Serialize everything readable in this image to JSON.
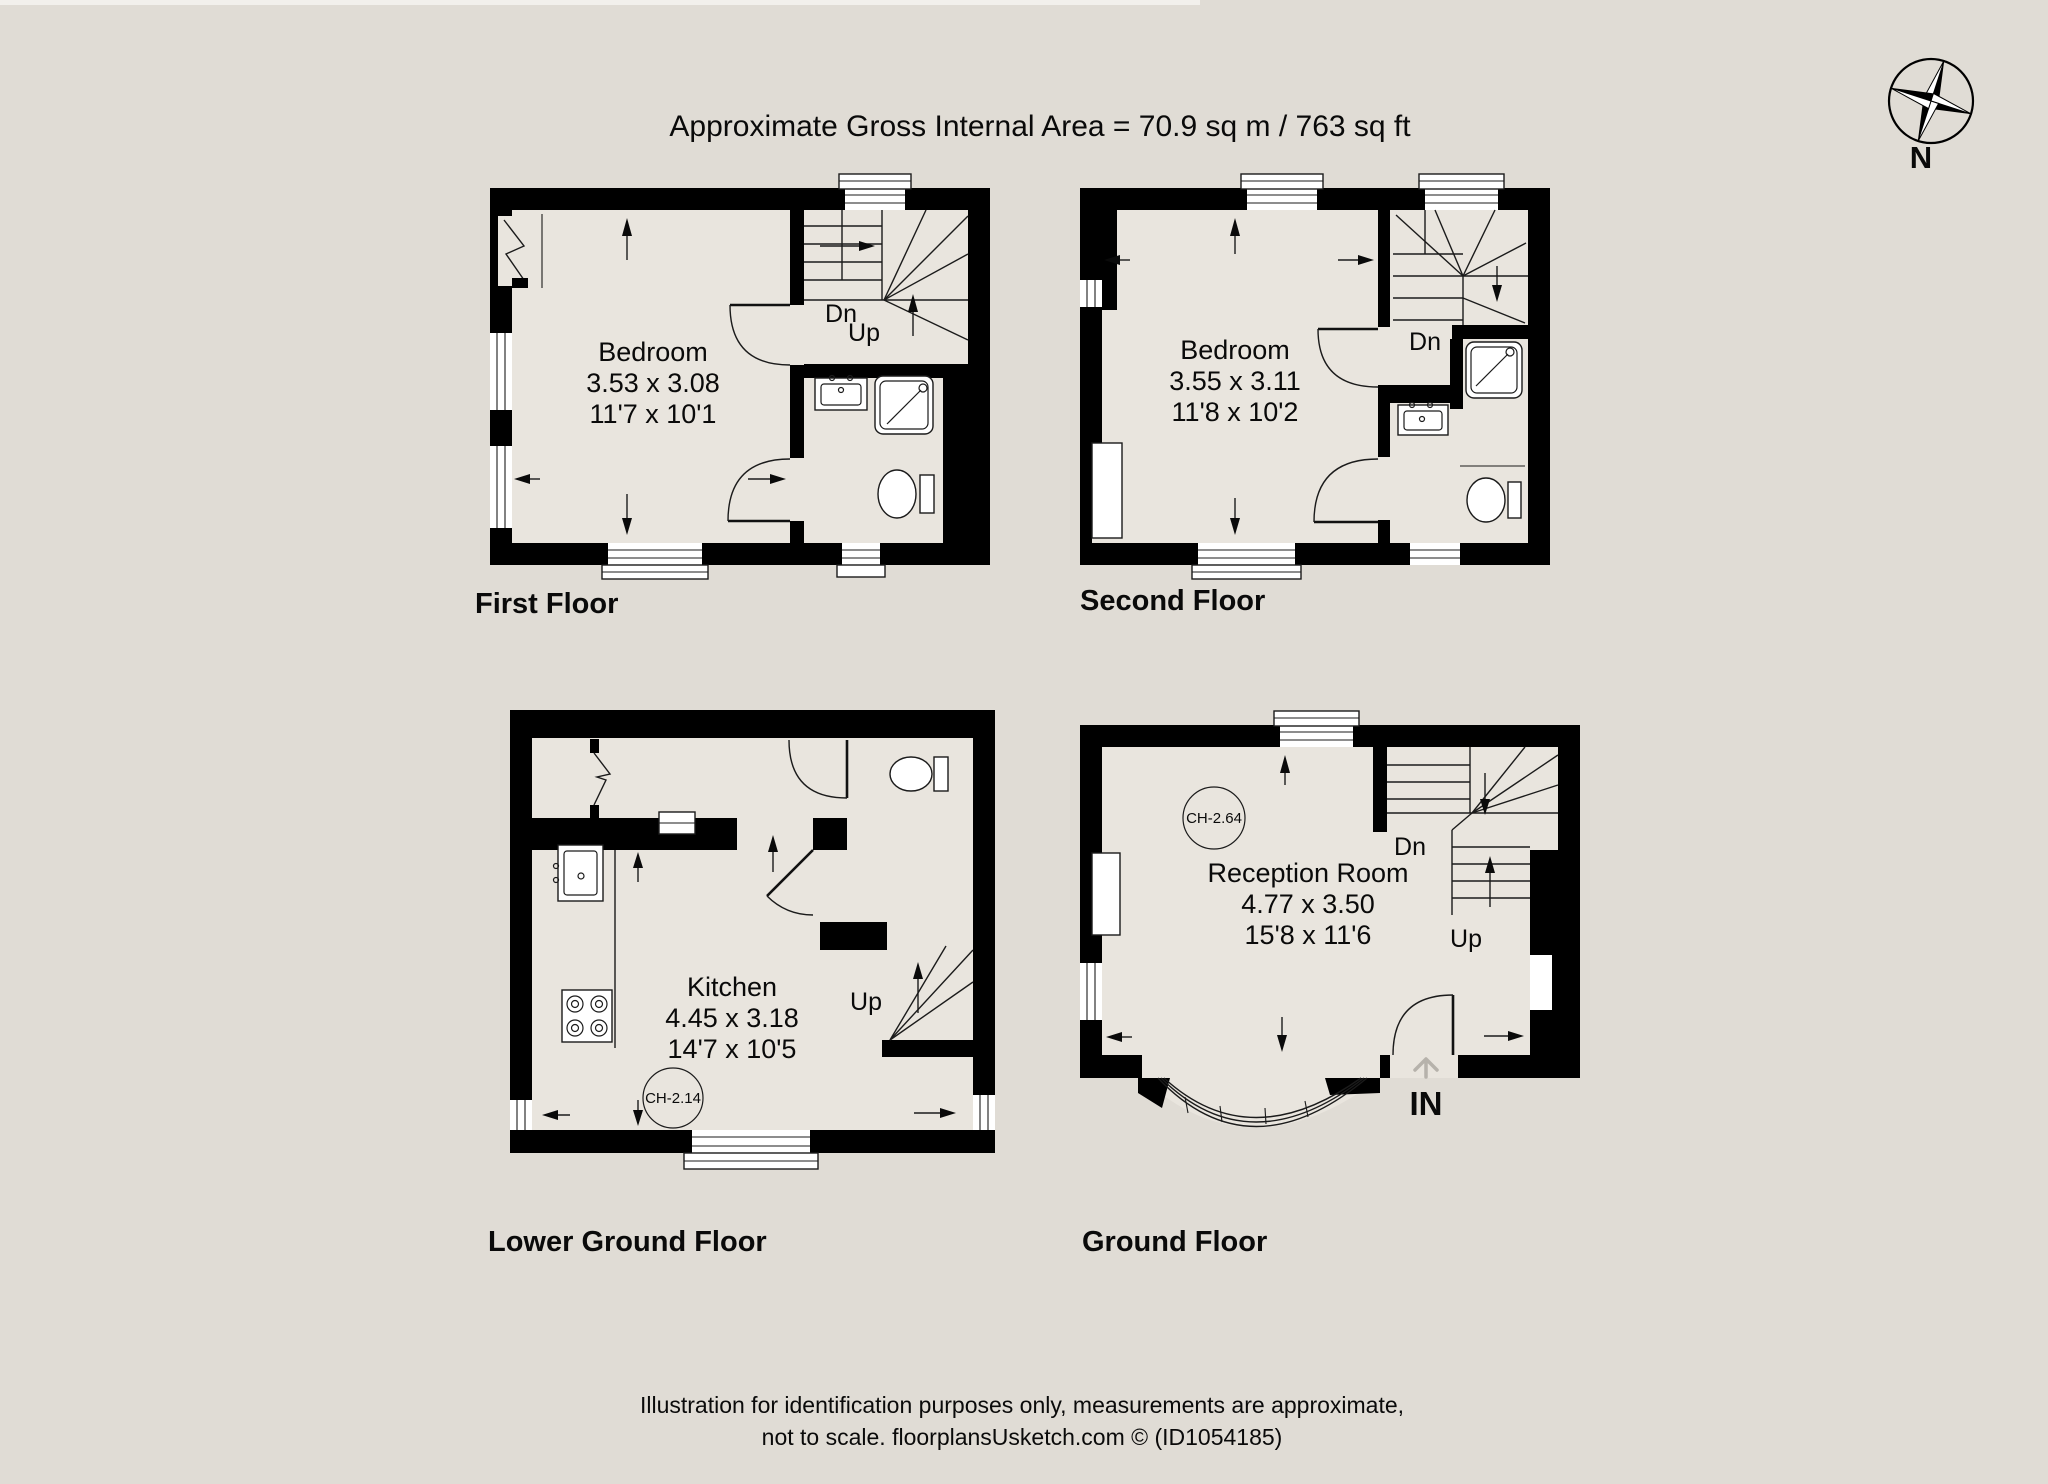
{
  "page": {
    "title": "Approximate Gross Internal Area = 70.9 sq m / 763 sq ft",
    "compass_label": "N",
    "footer_line1": "Illustration for identification purposes only, measurements are approximate,",
    "footer_line2": "not to scale. floorplansUsketch.com © (ID1054185)"
  },
  "floors": {
    "first": {
      "label": "First Floor",
      "room": {
        "name": "Bedroom",
        "size_m": "3.53 x 3.08",
        "size_ft": "11'7 x 10'1"
      },
      "stair_down": "Dn",
      "stair_up": "Up"
    },
    "second": {
      "label": "Second Floor",
      "room": {
        "name": "Bedroom",
        "size_m": "3.55 x 3.11",
        "size_ft": "11'8 x 10'2"
      },
      "stair_down": "Dn"
    },
    "lower_ground": {
      "label": "Lower Ground Floor",
      "room": {
        "name": "Kitchen",
        "size_m": "4.45 x 3.18",
        "size_ft": "14'7 x 10'5"
      },
      "stair_up": "Up",
      "ceiling_height": "CH-2.14"
    },
    "ground": {
      "label": "Ground Floor",
      "room": {
        "name": "Reception Room",
        "size_m": "4.77 x 3.50",
        "size_ft": "15'8 x 11'6"
      },
      "stair_down": "Dn",
      "stair_up": "Up",
      "entrance": "IN",
      "ceiling_height": "CH-2.64"
    }
  },
  "colors": {
    "background": "#e0dcd5",
    "wall": "#000000",
    "room_fill": "#e9e5de",
    "line": "#1b1b1b"
  }
}
